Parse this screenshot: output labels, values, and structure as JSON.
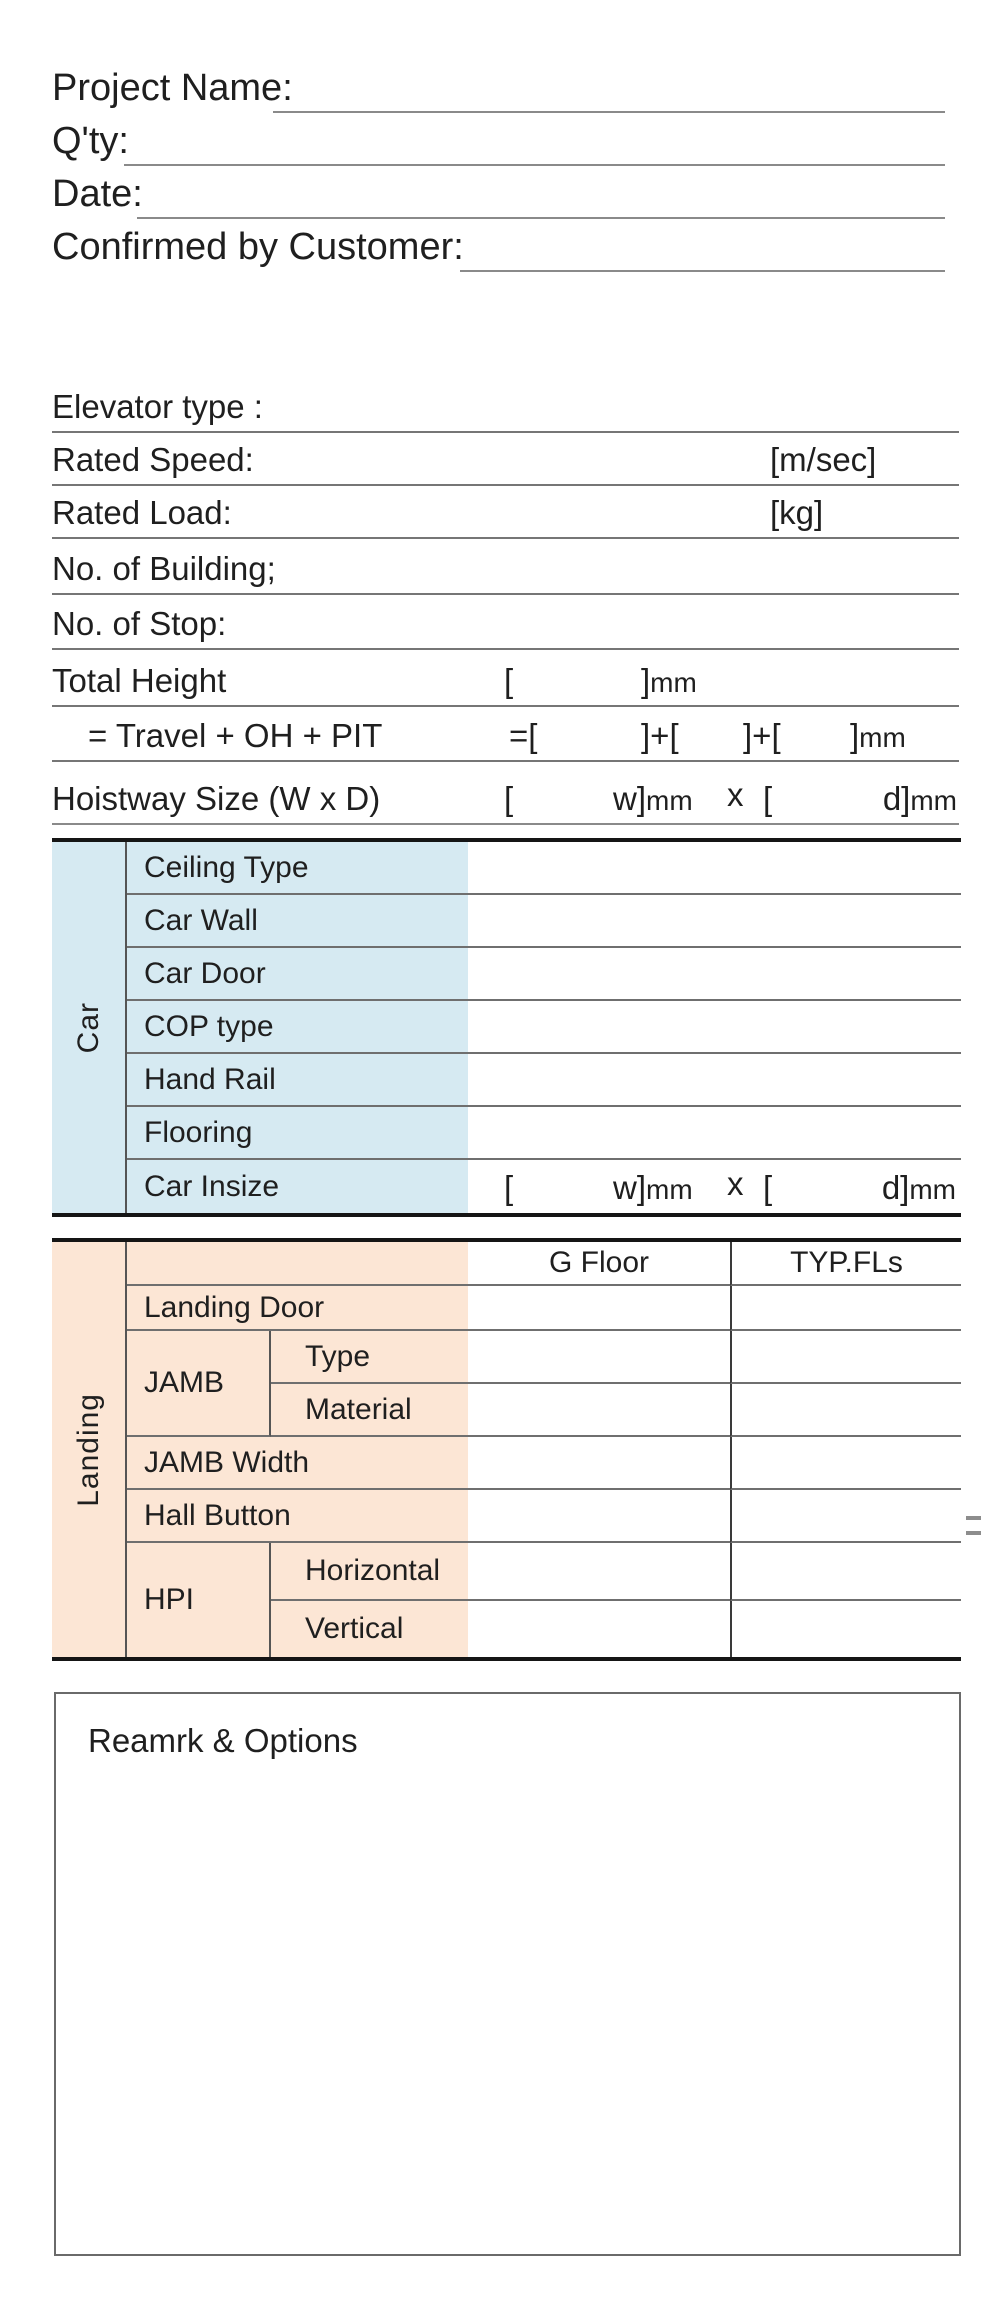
{
  "header_fields": [
    {
      "label": "Project Name:"
    },
    {
      "label": "Q'ty:"
    },
    {
      "label": "Date:"
    },
    {
      "label": "Confirmed by Customer:"
    }
  ],
  "spec": {
    "rows": [
      {
        "label": "Elevator type :"
      },
      {
        "label": "Rated Speed:",
        "unit": "[m/sec]"
      },
      {
        "label": "Rated Load:",
        "unit": "[kg]"
      },
      {
        "label": "No. of Building;"
      },
      {
        "label": "No. of Stop:"
      },
      {
        "label": "Total Height",
        "b1": "[",
        "b2": "]",
        "b2mm": "mm"
      },
      {
        "label": "= Travel + OH + PIT",
        "b1": "=[",
        "b2": "]+[",
        "b3": "]+[",
        "b4": "]",
        "b4mm": "mm"
      },
      {
        "label": "Hoistway Size (W x D)",
        "b1": "[",
        "b2": "w]",
        "b2mm": "mm",
        "x": "x",
        "b3": "[",
        "b4": "d]",
        "b4mm": "mm"
      }
    ]
  },
  "car_table": {
    "group_label": "Car",
    "row_labels": [
      "Ceiling Type",
      "Car Wall",
      "Car Door",
      "COP type",
      "Hand Rail",
      "Flooring",
      "Car Insize"
    ],
    "insize": {
      "b1": "[",
      "b2": "w]",
      "b2mm": "mm",
      "x": "x",
      "b3": "[",
      "b4": "d]",
      "b4mm": "mm"
    }
  },
  "landing_table": {
    "group_label": "Landing",
    "col_headers": [
      "G Floor",
      "TYP.FLs"
    ],
    "row_labels": {
      "landing_door": "Landing Door",
      "jamb": "JAMB",
      "jamb_type": "Type",
      "jamb_material": "Material",
      "jamb_width": "JAMB Width",
      "hall_button": "Hall Button",
      "hpi": "HPI",
      "hpi_horizontal": "Horizontal",
      "hpi_vertical": "Vertical"
    }
  },
  "remarks": {
    "title": "Reamrk & Options"
  },
  "colors": {
    "car_section_bg": "#d6eaf2",
    "landing_section_bg": "#fce6d5",
    "thick_border": "#151515",
    "thin_line": "#767676"
  }
}
